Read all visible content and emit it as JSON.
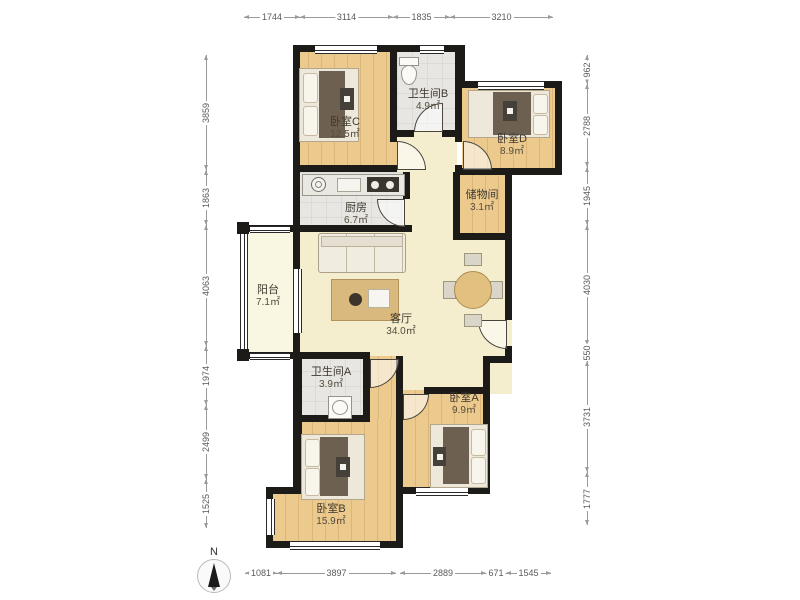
{
  "rooms": {
    "bedroomC": {
      "name": "卧室C",
      "area": "12.5㎡"
    },
    "bathB": {
      "name": "卫生间B",
      "area": "4.9㎡"
    },
    "bedroomD": {
      "name": "卧室D",
      "area": "8.9㎡"
    },
    "kitchen": {
      "name": "厨房",
      "area": "6.7㎡"
    },
    "storage": {
      "name": "储物间",
      "area": "3.1㎡"
    },
    "balcony": {
      "name": "阳台",
      "area": "7.1㎡"
    },
    "living": {
      "name": "客厅",
      "area": "34.0㎡"
    },
    "bathA": {
      "name": "卫生间A",
      "area": "3.9㎡"
    },
    "bedroomA": {
      "name": "卧室A",
      "area": "9.9㎡"
    },
    "bedroomB": {
      "name": "卧室B",
      "area": "15.9㎡"
    }
  },
  "dimensions": {
    "top": [
      "1744",
      "3114",
      "1835",
      "3210"
    ],
    "bottom": [
      "1081",
      "3897",
      "2889",
      "671",
      "1545"
    ],
    "left": [
      "3859",
      "1863",
      "4063",
      "1974",
      "2499",
      "1525"
    ],
    "right": [
      "962",
      "2788",
      "1945",
      "4030",
      "550",
      "3731",
      "1777"
    ]
  },
  "compass": {
    "label": "N"
  },
  "colors": {
    "wall": "#1d1b18",
    "wood_floor": "#e9c78a",
    "tile_floor": "#e7e6e2",
    "living_floor": "#f4eecf",
    "balcony_floor": "#f9f6e2",
    "dimension_text": "#5a5a5a"
  }
}
